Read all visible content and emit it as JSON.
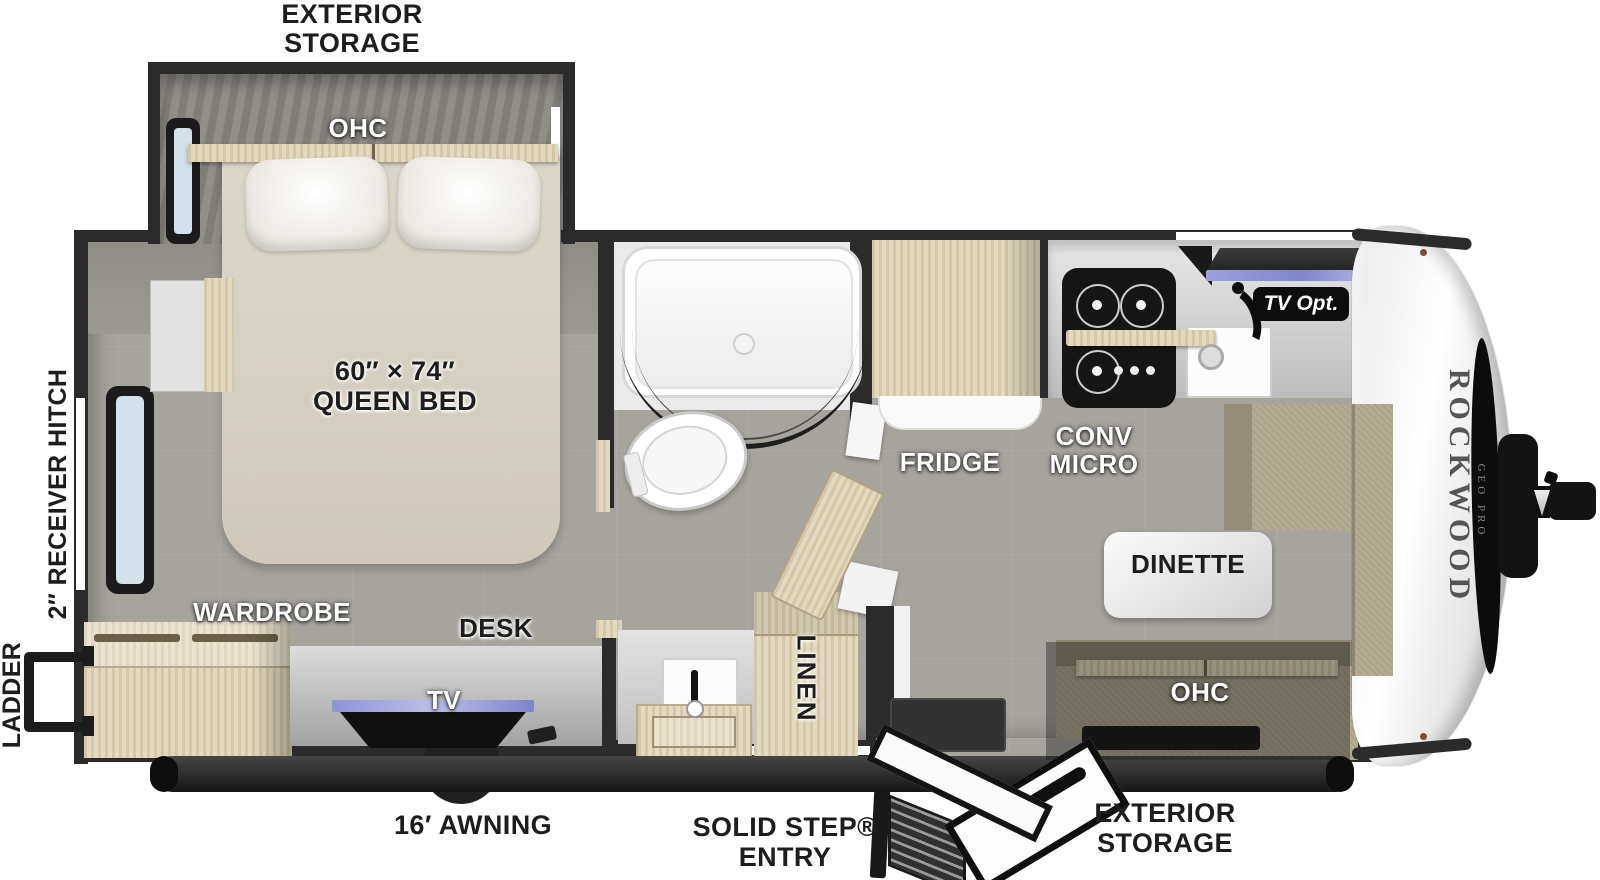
{
  "labels": {
    "exterior_storage_top": {
      "line1": "EXTERIOR",
      "line2": "STORAGE"
    },
    "exterior_storage_bottom": {
      "line1": "EXTERIOR",
      "line2": "STORAGE"
    },
    "solid_step_entry": {
      "line1": "SOLID STEP®",
      "line2": "ENTRY"
    },
    "awning": "16′ AWNING",
    "receiver_hitch": "2″ RECEIVER HITCH",
    "ladder": "LADDER",
    "bed_ohc": "OHC",
    "queen_bed": {
      "line1": "60″ × 74″",
      "line2": "QUEEN BED"
    },
    "wardrobe": "WARDROBE",
    "desk": "DESK",
    "desk_tv": "TV",
    "linen": "LINEN",
    "fridge": "FRIDGE",
    "conv_micro": {
      "line1": "CONV",
      "line2": "MICRO"
    },
    "tv_opt": "TV Opt.",
    "dinette": "DINETTE",
    "dinette_ohc": "OHC"
  },
  "brand": {
    "name": "ROCKWOOD",
    "series": "GEO PRO"
  },
  "colors": {
    "wall": "#2b2b2b",
    "floor": "#a7a49e",
    "wood": "#e0d5ba",
    "bench": "#b4ab94",
    "mattress": "#d8d2c5",
    "accent_led": "#8f95d6",
    "label_dark": "#1d1d1d",
    "label_white": "#ffffff"
  }
}
